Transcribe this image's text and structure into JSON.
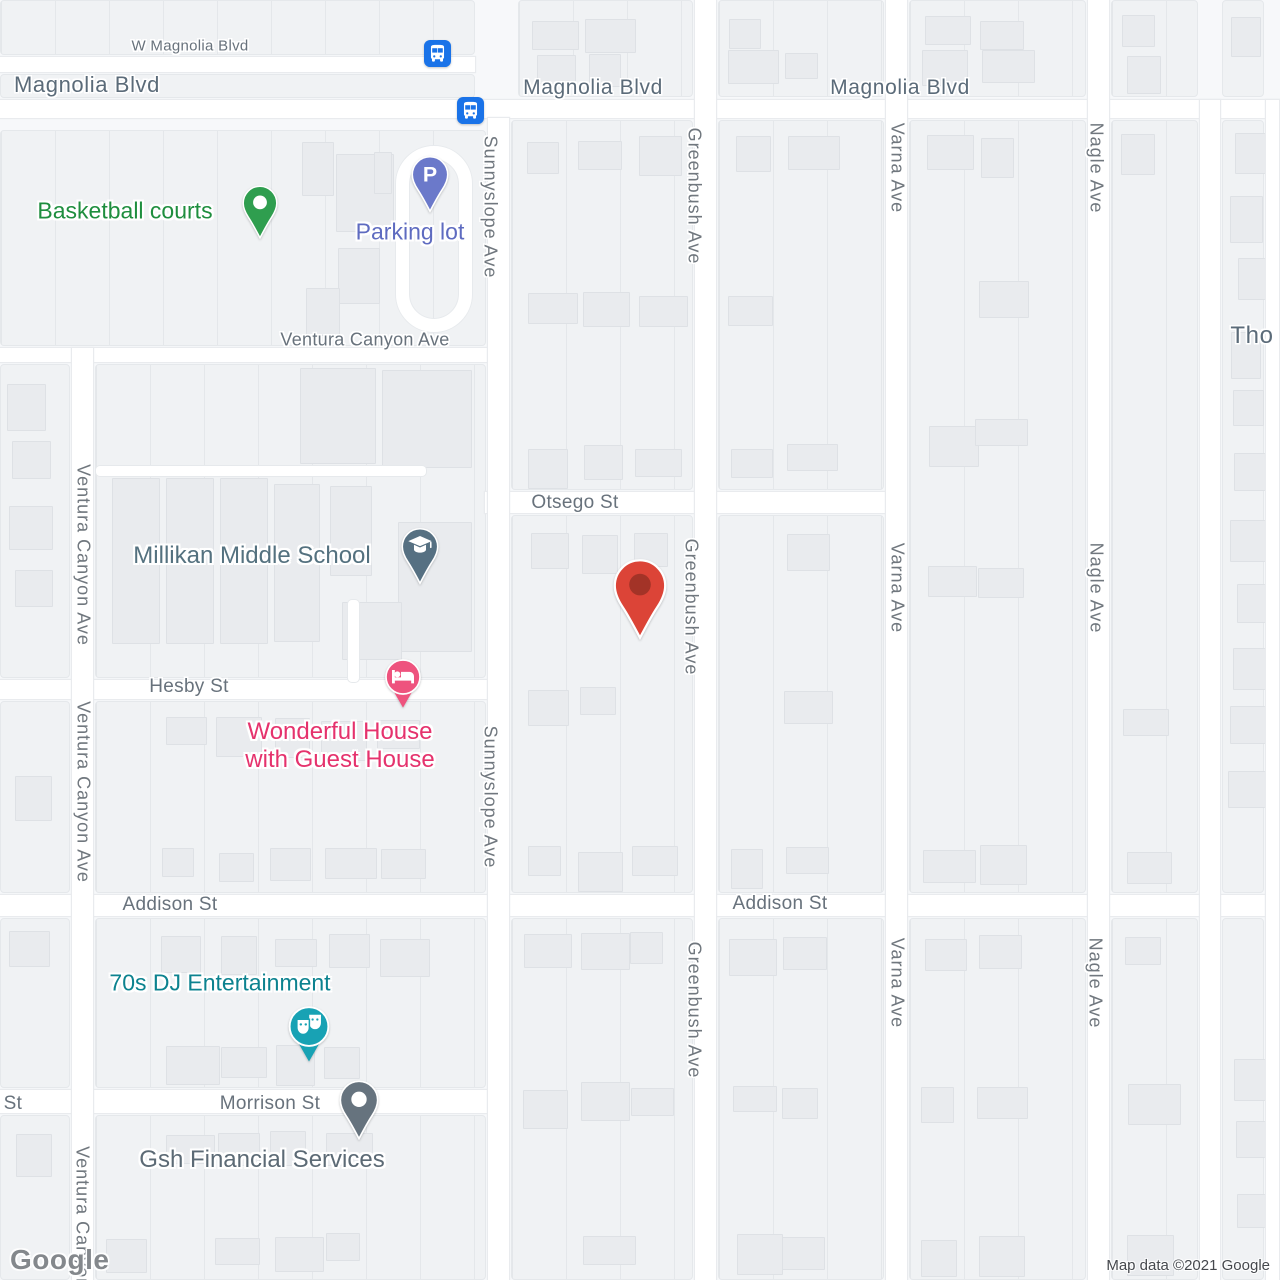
{
  "map": {
    "watermark": "Google",
    "attribution": "Map data ©2021 Google"
  },
  "street_labels": [
    {
      "id": "w-magnolia-blvd",
      "text": "W Magnolia Blvd",
      "x": 190,
      "y": 46,
      "size": 15,
      "tone": "minor",
      "vertical": false
    },
    {
      "id": "magnolia-blvd-left",
      "text": "Magnolia Blvd",
      "x": 87,
      "y": 85,
      "size": 22,
      "tone": "major",
      "vertical": false
    },
    {
      "id": "magnolia-blvd-center",
      "text": "Magnolia Blvd",
      "x": 593,
      "y": 88,
      "size": 21,
      "tone": "major",
      "vertical": false
    },
    {
      "id": "magnolia-blvd-right",
      "text": "Magnolia Blvd",
      "x": 900,
      "y": 88,
      "size": 21,
      "tone": "major",
      "vertical": false
    },
    {
      "id": "ventura-canyon-ave-horizontal",
      "text": "Ventura Canyon Ave",
      "x": 365,
      "y": 340,
      "size": 18,
      "tone": "minor",
      "vertical": false
    },
    {
      "id": "otsego-st",
      "text": "Otsego St",
      "x": 575,
      "y": 503,
      "size": 19,
      "tone": "minor",
      "vertical": false
    },
    {
      "id": "hesby-st",
      "text": "Hesby St",
      "x": 189,
      "y": 687,
      "size": 19,
      "tone": "minor",
      "vertical": false
    },
    {
      "id": "addison-st-west",
      "text": "Addison St",
      "x": 170,
      "y": 905,
      "size": 19,
      "tone": "minor",
      "vertical": false
    },
    {
      "id": "addison-st-east",
      "text": "Addison St",
      "x": 780,
      "y": 904,
      "size": 19,
      "tone": "minor",
      "vertical": false
    },
    {
      "id": "morrison-st-cut",
      "text": "Morrison St",
      "x": -28,
      "y": 1104,
      "size": 19,
      "tone": "minor",
      "vertical": false
    },
    {
      "id": "morrison-st",
      "text": "Morrison St",
      "x": 270,
      "y": 1104,
      "size": 19,
      "tone": "minor",
      "vertical": false
    },
    {
      "id": "thornton-partial",
      "text": "Tho",
      "x": 1252,
      "y": 336,
      "size": 24,
      "tone": "major",
      "vertical": false
    },
    {
      "id": "sunnyslope-ave-north",
      "text": "Sunnyslope Ave",
      "x": 490,
      "y": 207,
      "size": 18,
      "tone": "vert",
      "vertical": true
    },
    {
      "id": "sunnyslope-ave-south",
      "text": "Sunnyslope Ave",
      "x": 490,
      "y": 797,
      "size": 18,
      "tone": "vert",
      "vertical": true
    },
    {
      "id": "greenbush-ave-north",
      "text": "Greenbush Ave",
      "x": 694,
      "y": 196,
      "size": 18,
      "tone": "vert",
      "vertical": true
    },
    {
      "id": "greenbush-ave-mid",
      "text": "Greenbush Ave",
      "x": 691,
      "y": 607,
      "size": 18,
      "tone": "vert",
      "vertical": true
    },
    {
      "id": "greenbush-ave-south",
      "text": "Greenbush Ave",
      "x": 694,
      "y": 1010,
      "size": 18,
      "tone": "vert",
      "vertical": true
    },
    {
      "id": "varna-ave-north",
      "text": "Varna Ave",
      "x": 897,
      "y": 168,
      "size": 18,
      "tone": "vert",
      "vertical": true
    },
    {
      "id": "varna-ave-mid",
      "text": "Varna Ave",
      "x": 897,
      "y": 588,
      "size": 18,
      "tone": "vert",
      "vertical": true
    },
    {
      "id": "varna-ave-south",
      "text": "Varna Ave",
      "x": 897,
      "y": 983,
      "size": 18,
      "tone": "vert",
      "vertical": true
    },
    {
      "id": "nagle-ave-north",
      "text": "Nagle Ave",
      "x": 1096,
      "y": 168,
      "size": 18,
      "tone": "vert",
      "vertical": true
    },
    {
      "id": "nagle-ave-mid",
      "text": "Nagle Ave",
      "x": 1096,
      "y": 588,
      "size": 18,
      "tone": "vert",
      "vertical": true
    },
    {
      "id": "nagle-ave-south",
      "text": "Nagle Ave",
      "x": 1095,
      "y": 983,
      "size": 18,
      "tone": "vert",
      "vertical": true
    },
    {
      "id": "ventura-canyon-ave-upper",
      "text": "Ventura Canyon Ave",
      "x": 83,
      "y": 555,
      "size": 18,
      "tone": "vert",
      "vertical": true
    },
    {
      "id": "ventura-canyon-ave-lower",
      "text": "Ventura Canyon Ave",
      "x": 83,
      "y": 792,
      "size": 18,
      "tone": "vert",
      "vertical": true
    },
    {
      "id": "ventura-canyon-ave-bottom",
      "text": "Ventura Canyon Ave",
      "x": 82,
      "y": 1237,
      "size": 18,
      "tone": "vert",
      "vertical": true
    }
  ],
  "poi_labels": [
    {
      "id": "basketball-courts",
      "lines": [
        "Basketball courts"
      ],
      "x": 125,
      "y": 211,
      "color": "#1e8e3e",
      "size": 23
    },
    {
      "id": "parking-lot",
      "lines": [
        "Parking lot"
      ],
      "x": 410,
      "y": 232,
      "color": "#5e6bc0",
      "size": 23
    },
    {
      "id": "millikan-middle-school",
      "lines": [
        "Millikan Middle School"
      ],
      "x": 252,
      "y": 556,
      "color": "#54717f",
      "size": 24
    },
    {
      "id": "wonderful-house",
      "lines": [
        "Wonderful House",
        "with Guest House"
      ],
      "x": 340,
      "y": 746,
      "color": "#e5326d",
      "size": 24
    },
    {
      "id": "dj-entertainment",
      "lines": [
        "70s DJ Entertainment"
      ],
      "x": 220,
      "y": 983,
      "color": "#0c828f",
      "size": 23
    },
    {
      "id": "gsh-financial",
      "lines": [
        "Gsh Financial Services"
      ],
      "x": 262,
      "y": 1160,
      "color": "#5c6a75",
      "size": 24
    }
  ],
  "markers": [
    {
      "id": "bus-stop-north",
      "type": "bus",
      "x": 437,
      "y": 53,
      "w": 27,
      "h": 27,
      "color": "#1a73e8",
      "glyph": "bus"
    },
    {
      "id": "bus-stop-south",
      "type": "bus",
      "x": 470,
      "y": 110,
      "w": 27,
      "h": 27,
      "color": "#1a73e8",
      "glyph": "bus"
    },
    {
      "id": "basketball-courts-pin",
      "type": "teardrop",
      "x": 260,
      "y": 240,
      "w": 36,
      "h": 56,
      "color": "#2f9e4f",
      "glyph": "dot"
    },
    {
      "id": "parking-lot-pin",
      "type": "teardrop",
      "x": 430,
      "y": 213,
      "w": 38,
      "h": 58,
      "color": "#6b79ca",
      "glyph": "P"
    },
    {
      "id": "school-pin",
      "type": "teardrop",
      "x": 420,
      "y": 585,
      "w": 38,
      "h": 58,
      "color": "#567082",
      "glyph": "cap"
    },
    {
      "id": "destination-pin",
      "type": "teardrop",
      "x": 640,
      "y": 641,
      "w": 54,
      "h": 84,
      "color": "#dc4437",
      "glyph": "dot-dark",
      "inner": "#a33327"
    },
    {
      "id": "lodging-pin",
      "type": "circlepin",
      "x": 403,
      "y": 709,
      "w": 40,
      "h": 50,
      "color": "#ee537e",
      "glyph": "bed"
    },
    {
      "id": "entertainment-pin",
      "type": "circlepin",
      "x": 309,
      "y": 1063,
      "w": 46,
      "h": 57,
      "color": "#18a2b4",
      "glyph": "masks"
    },
    {
      "id": "gsh-pin",
      "type": "teardrop",
      "x": 359,
      "y": 1140,
      "w": 40,
      "h": 60,
      "color": "#66737e",
      "glyph": "dot"
    }
  ]
}
